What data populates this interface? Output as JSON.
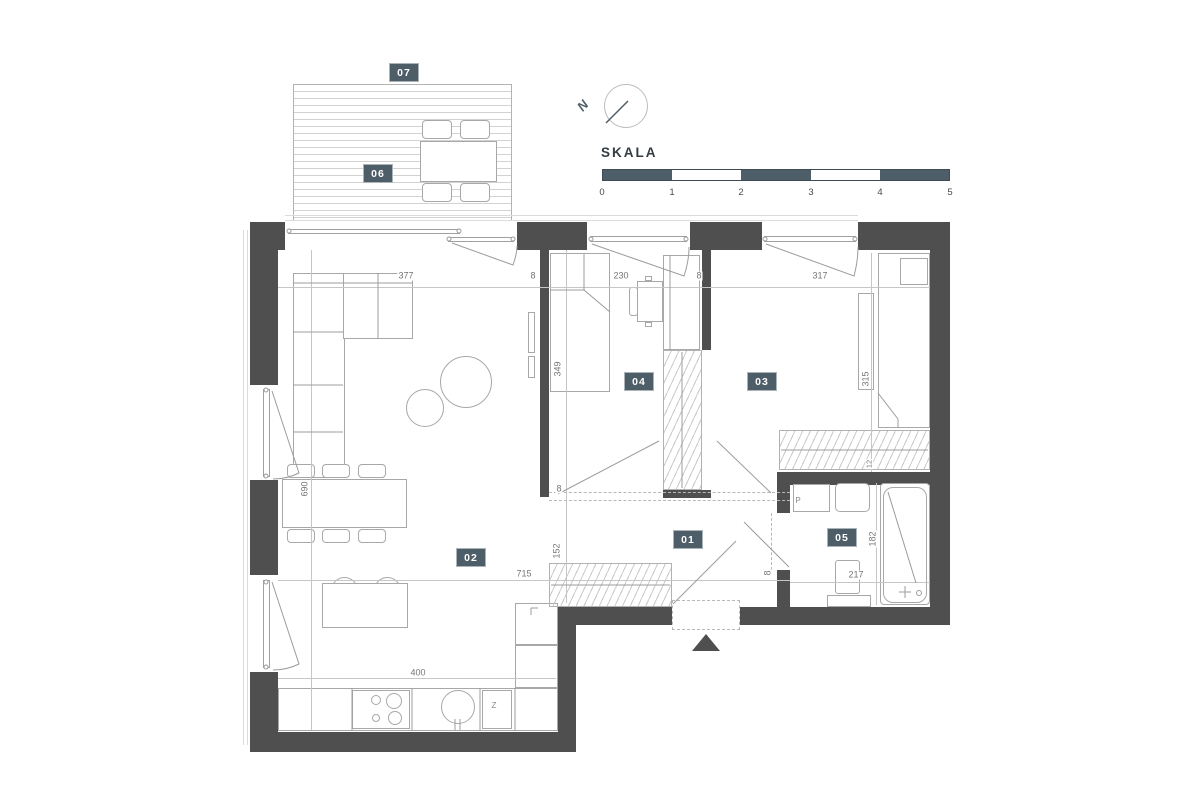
{
  "colors": {
    "accent": "#4d5e69",
    "wall": "#4f4f4f",
    "line": "#9c9c9c",
    "background": "#ffffff"
  },
  "compass": {
    "letter": "N"
  },
  "scale_bar": {
    "title": "SKALA",
    "ticks": [
      "0",
      "1",
      "2",
      "3",
      "4",
      "5"
    ]
  },
  "rooms": {
    "r01": "01",
    "r02": "02",
    "r03": "03",
    "r04": "04",
    "r05": "05",
    "r06": "06",
    "r07": "07"
  },
  "dimensions": {
    "living_width": "377",
    "wall_a": "8",
    "room04_width": "230",
    "wall_b": "8",
    "room03_width": "317",
    "room04_depth": "349",
    "hall_wall": "8",
    "living_depth": "690",
    "hall_depth": "152",
    "open_width": "715",
    "bath_door_wall": "8",
    "bed_length": "315",
    "bed_gap": "12",
    "bathtub_length": "182",
    "bath_width": "217",
    "kitchen_width": "400"
  },
  "appliances": {
    "washing_machine": "P",
    "dishwasher": "Z"
  }
}
